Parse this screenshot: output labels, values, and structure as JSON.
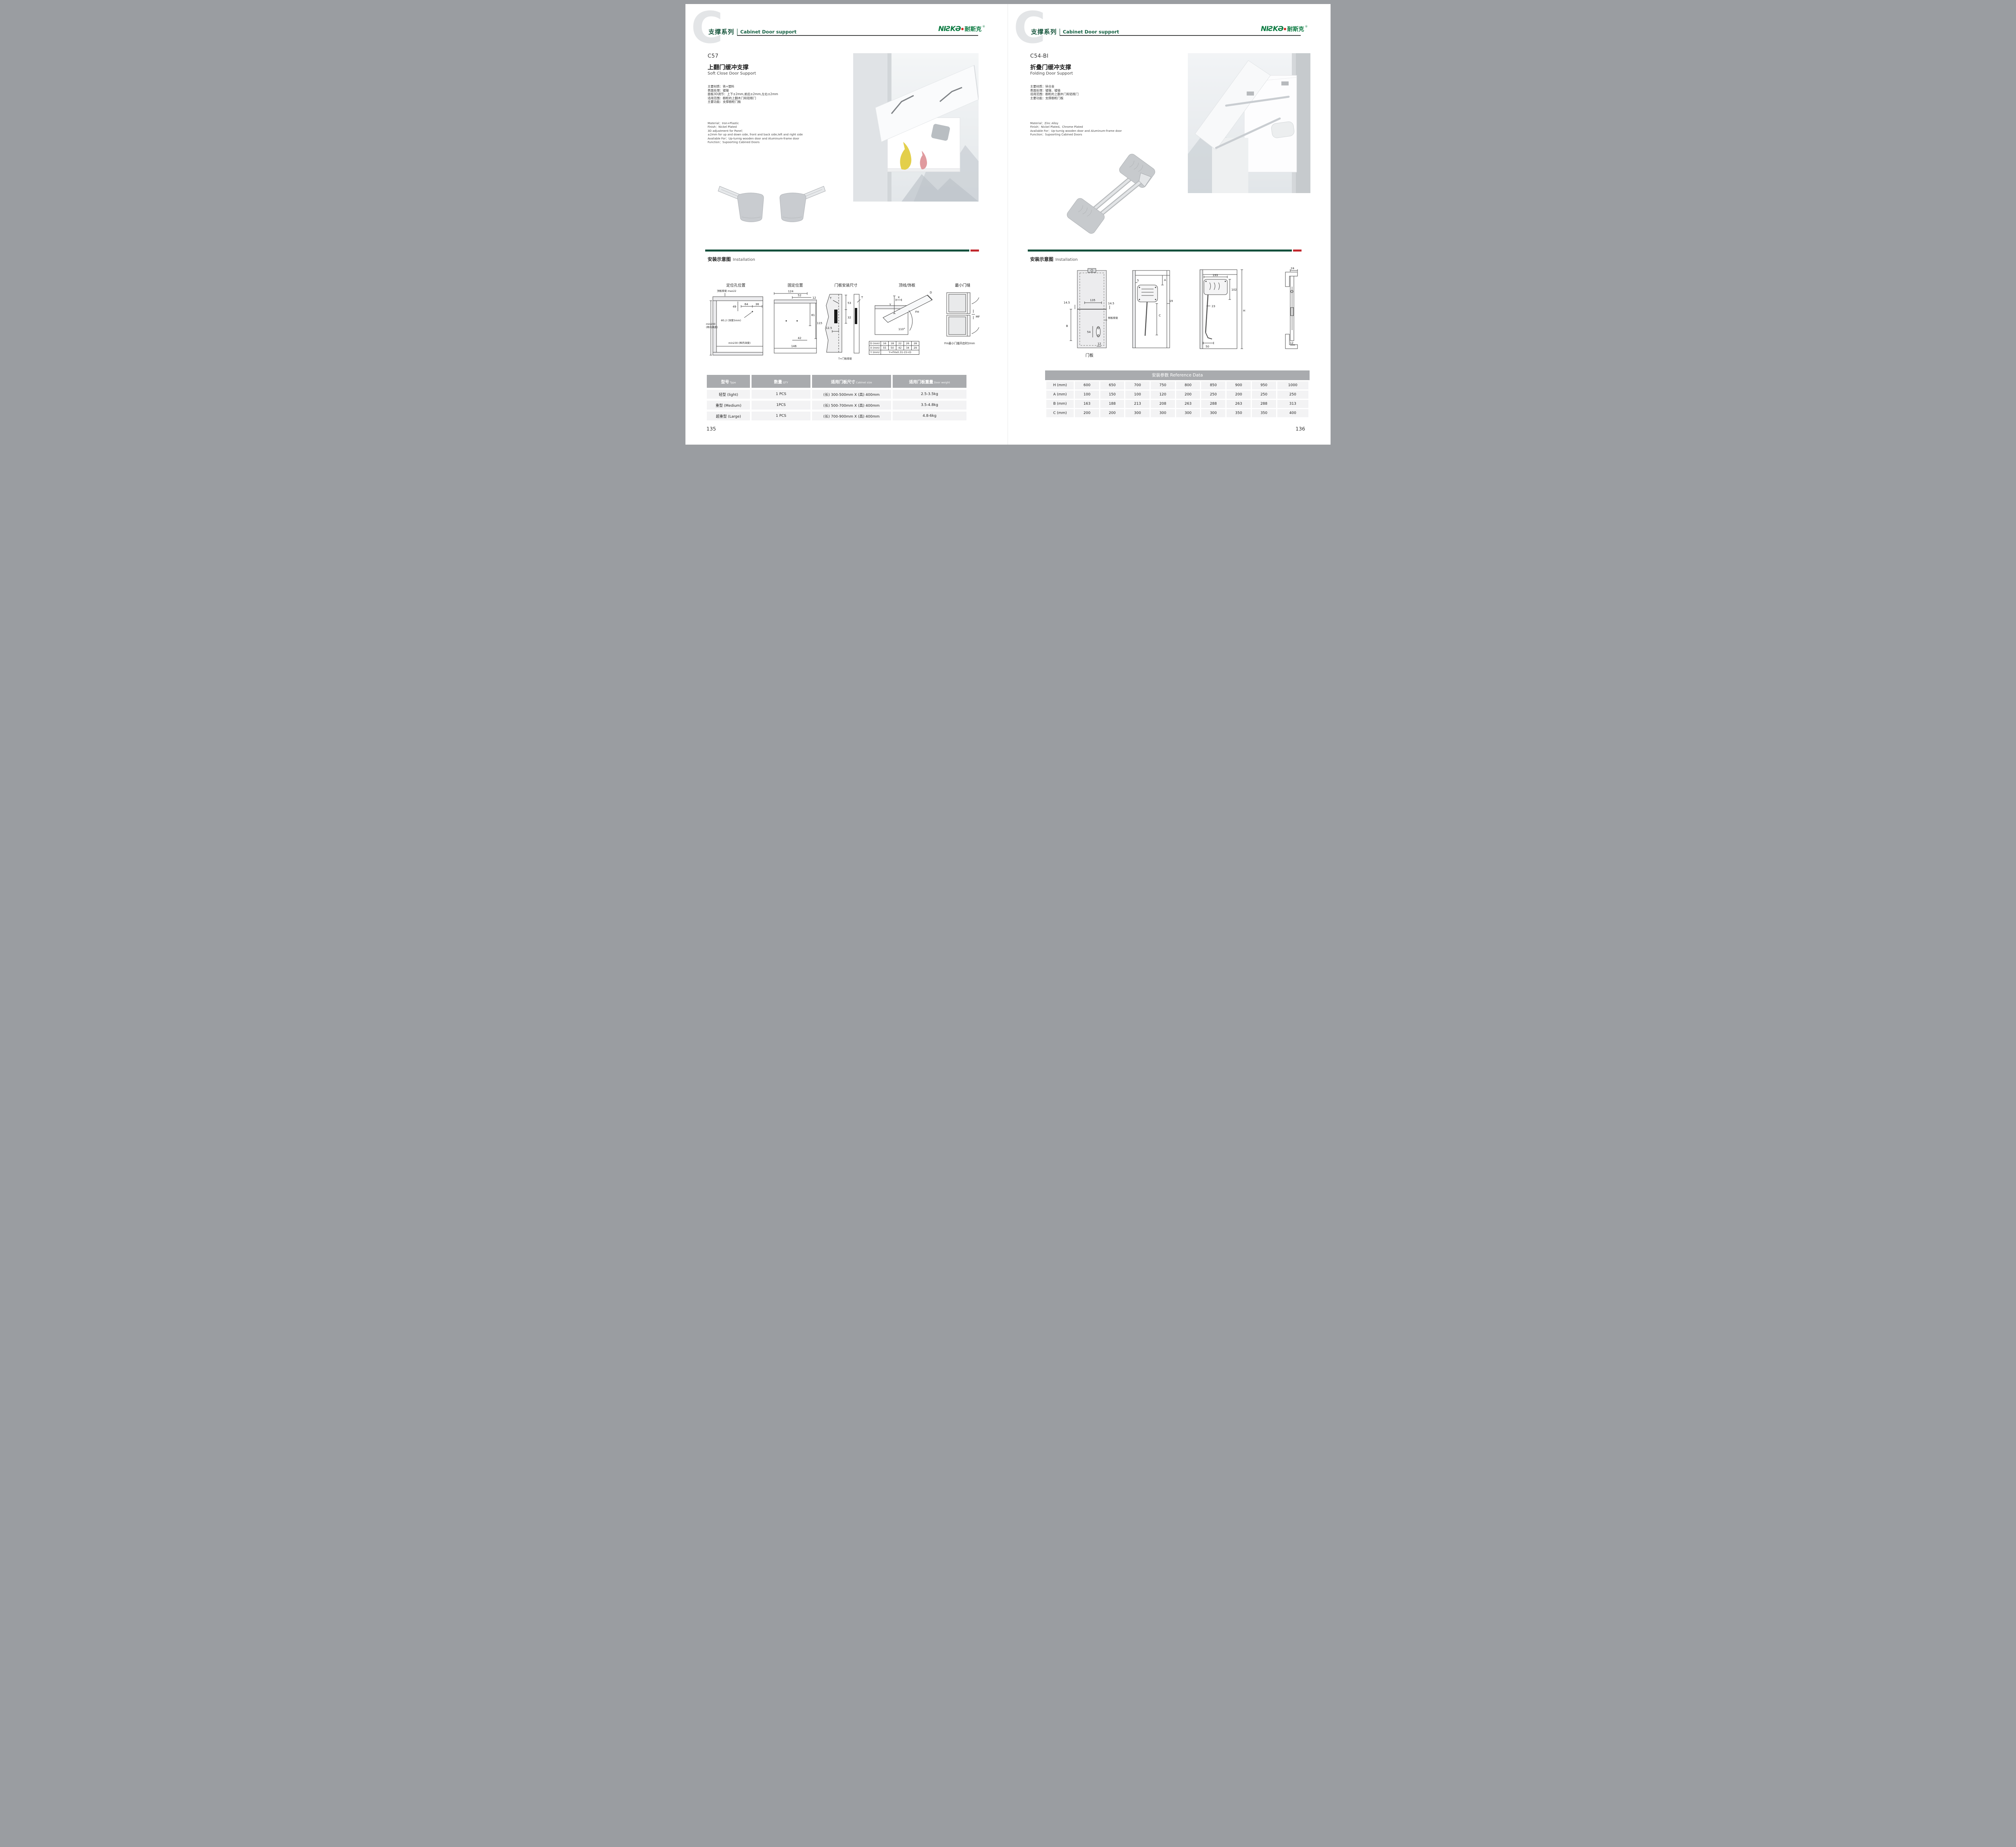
{
  "brand": {
    "logo_en": "NIƧKƏ",
    "logo_cn": "耐斯克",
    "logo_reg": "®"
  },
  "colors": {
    "heading_green": "#14533A",
    "logo_green": "#0B7A41",
    "accent_red": "#C1272D",
    "table_header_gray": "#A9ABAE"
  },
  "pages": [
    {
      "header": {
        "letter": "C",
        "series_cn": "支撑系列",
        "series_en": "Cabinet Door support"
      },
      "product": {
        "code": "C57",
        "title_cn": "上翻门缓冲支撑",
        "title_en": "Soft Close Door Support",
        "specs_cn": [
          "主要材质：铁+塑料",
          "表面处理：镀镍",
          "面板3D调节：上下±2mm,前后±2mm,左右±2mm",
          "适用范围：橱柜的上翻木门和铝框门",
          "主要功能：支撑橱柜门板"
        ],
        "specs_en": [
          "Material：Iron+Plastic",
          "Finish：Nickel Plated",
          "3D adjustment for Panel：",
          "±2mm for up and down side, front and back side,left and right side",
          "Available For：Up-turnig wooden door and Aluminum-frame door",
          "Function：Supoorting Cabined Doors"
        ]
      },
      "installation": {
        "title_cn": "安装示意图",
        "title_en": "Installation",
        "d1": {
          "label": "定位孔位置",
          "top_thickness": "顶板厚度 max22",
          "dim49": "49",
          "dim64": "64",
          "dim36": "36",
          "hole": "Φ5.2 (深度5mm)",
          "min_h1": "min200",
          "min_h2": "(柜内高度)",
          "min_d": "min230 (柜内深度)"
        },
        "d2": {
          "label": "固定位置",
          "dim124": "124",
          "dim52": "52",
          "dim12": "12",
          "dim81": "81",
          "dim115": "115",
          "dim42": "42",
          "dim146": "146"
        },
        "d3": {
          "label": "门板安装尺寸",
          "dim53": "53",
          "dim32": "32",
          "dim125": "12.5",
          "t_top": "T",
          "t_right": "T",
          "note": "T=门板厚度"
        },
        "d4": {
          "label": "顶线/饰板",
          "dim_y": "Y",
          "dim_x": "X",
          "dim_d": "D",
          "dim_fh": "FH",
          "angle": "110°"
        },
        "d5": {
          "label": "最小门缝",
          "mf": "MF",
          "note": "Fm最小门缝开启时2mm"
        },
        "dxy": {
          "d_label": "D (mm)",
          "d_values": [
            "16",
            "18",
            "22",
            "26",
            "28"
          ],
          "x_label": "X (mm)",
          "x_values": [
            "55",
            "50",
            "42",
            "34",
            "29"
          ],
          "y_label": "Y (mm)",
          "y_formula": "Y=FHx0.31-15+D"
        }
      },
      "table": {
        "headers": [
          {
            "cn": "型号",
            "en": "Type"
          },
          {
            "cn": "数量",
            "en": "QTY"
          },
          {
            "cn": "适用门板尺寸",
            "en": "Cabinet size"
          },
          {
            "cn": "适用门板重量",
            "en": "Door weight"
          }
        ],
        "rows": [
          [
            "轻型 (light)",
            "1 PCS",
            "(长) 300-500mm X (高) 400mm",
            "2.5-3.5kg"
          ],
          [
            "重型 (Medium)",
            "1PCS",
            "(长) 500-700mm X (高) 400mm",
            "3.5-4.8kg"
          ],
          [
            "超重型 (Large)",
            "1 PCS",
            "(长) 700-900mm X (高) 400mm",
            "4.8-6kg"
          ]
        ]
      },
      "page_number": "135"
    },
    {
      "header": {
        "letter": "C",
        "series_cn": "支撑系列",
        "series_en": "Cabinet Door support"
      },
      "product": {
        "code": "C54-BI",
        "title_cn": "折叠门缓冲支撑",
        "title_en": "Folding Door Support",
        "specs_cn": [
          "主要材质：锌合金",
          "表面处理：镀镍、镀铬",
          "适用范围：橱柜的上翻木门和铝框门",
          "主要功能：支撑橱柜门板"
        ],
        "specs_en": [
          "Material：Zinc Alloy",
          "Finish：Nickel Plated、Chrome Plated",
          "Available For：Up-turnig wooden door and Aluminum-frame door",
          "Function：Supoorting Cabined Doors"
        ]
      },
      "installation": {
        "title_cn": "安装示意图",
        "title_en": "Installation",
        "d1": {
          "caption": "门板",
          "dim135": "135",
          "dim145_l": "14.5",
          "dim145_r": "14.5",
          "dim_b": "B",
          "dim54": "54",
          "dim12": "12",
          "side_thickness": "侧板厚度"
        },
        "d2": {
          "dim5": "5",
          "dim_a": "A",
          "dim_c": "C",
          "dim19": "19"
        },
        "d3": {
          "dim193": "193",
          "dim102": "102",
          "dim23": "23",
          "dim50": "50",
          "dim_h": "H"
        },
        "d4": {
          "dim24": "24",
          "dim12": "12"
        }
      },
      "reference_table": {
        "title": "安装参数 Reference Data",
        "rows": [
          [
            "H (mm)",
            "600",
            "650",
            "700",
            "750",
            "800",
            "850",
            "900",
            "950",
            "1000"
          ],
          [
            "A (mm)",
            "100",
            "150",
            "100",
            "120",
            "200",
            "250",
            "200",
            "250",
            "250"
          ],
          [
            "B (mm)",
            "163",
            "188",
            "213",
            "208",
            "263",
            "288",
            "263",
            "288",
            "313"
          ],
          [
            "C (mm)",
            "200",
            "200",
            "300",
            "300",
            "300",
            "300",
            "350",
            "350",
            "400"
          ]
        ]
      },
      "page_number": "136"
    }
  ]
}
